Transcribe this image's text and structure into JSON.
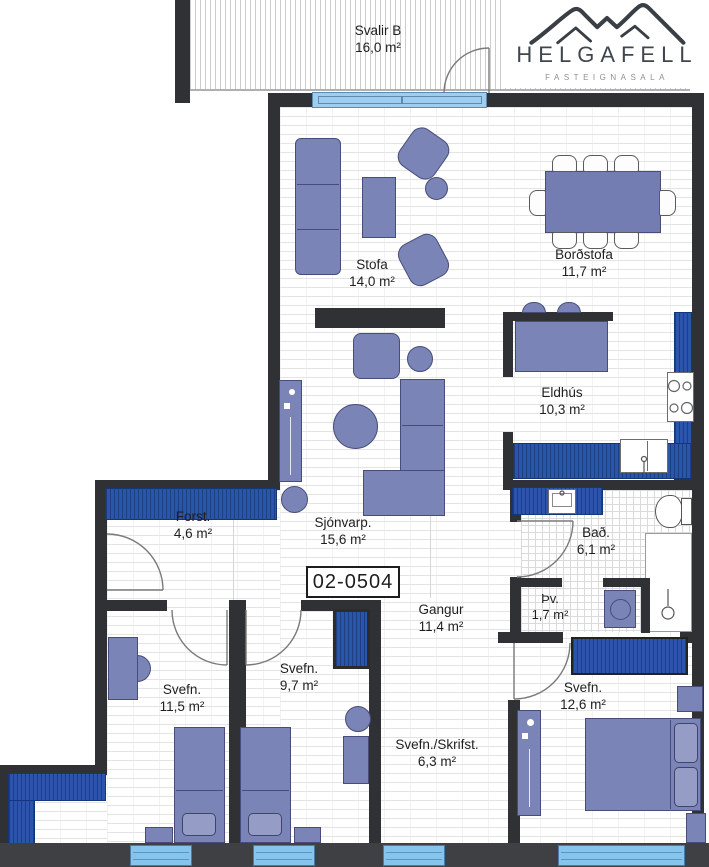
{
  "meta": {
    "apartment_id": "02-0504"
  },
  "logo": {
    "title": "HELGAFELL",
    "subtitle": "FASTEIGNASALA"
  },
  "rooms": {
    "svalir": {
      "name": "Svalir B",
      "area": "16,0 m²"
    },
    "stofa": {
      "name": "Stofa",
      "area": "14,0 m²"
    },
    "bordstofa": {
      "name": "Borðstofa",
      "area": "11,7 m²"
    },
    "eldhus": {
      "name": "Eldhús",
      "area": "10,3 m²"
    },
    "sjonvarp": {
      "name": "Sjónvarp.",
      "area": "15,6 m²"
    },
    "forst": {
      "name": "Forst.",
      "area": "4,6 m²"
    },
    "gangur": {
      "name": "Gangur",
      "area": "11,4 m²"
    },
    "bad": {
      "name": "Bað.",
      "area": "6,1 m²"
    },
    "thvottahus": {
      "name": "Þv.",
      "area": "1,7 m²"
    },
    "svefn_1": {
      "name": "Svefn.",
      "area": "11,5 m²"
    },
    "svefn_2": {
      "name": "Svefn.",
      "area": "9,7 m²"
    },
    "svefn_skrifst": {
      "name": "Svefn./Skrifst.",
      "area": "6,3 m²"
    },
    "svefn_3": {
      "name": "Svefn.",
      "area": "12,6 m²"
    }
  },
  "colors": {
    "wall": "#2f3134",
    "furniture": "#7b84b6",
    "cabinet_blue": "#2a55aa",
    "window_blue": "#85c4ec"
  }
}
